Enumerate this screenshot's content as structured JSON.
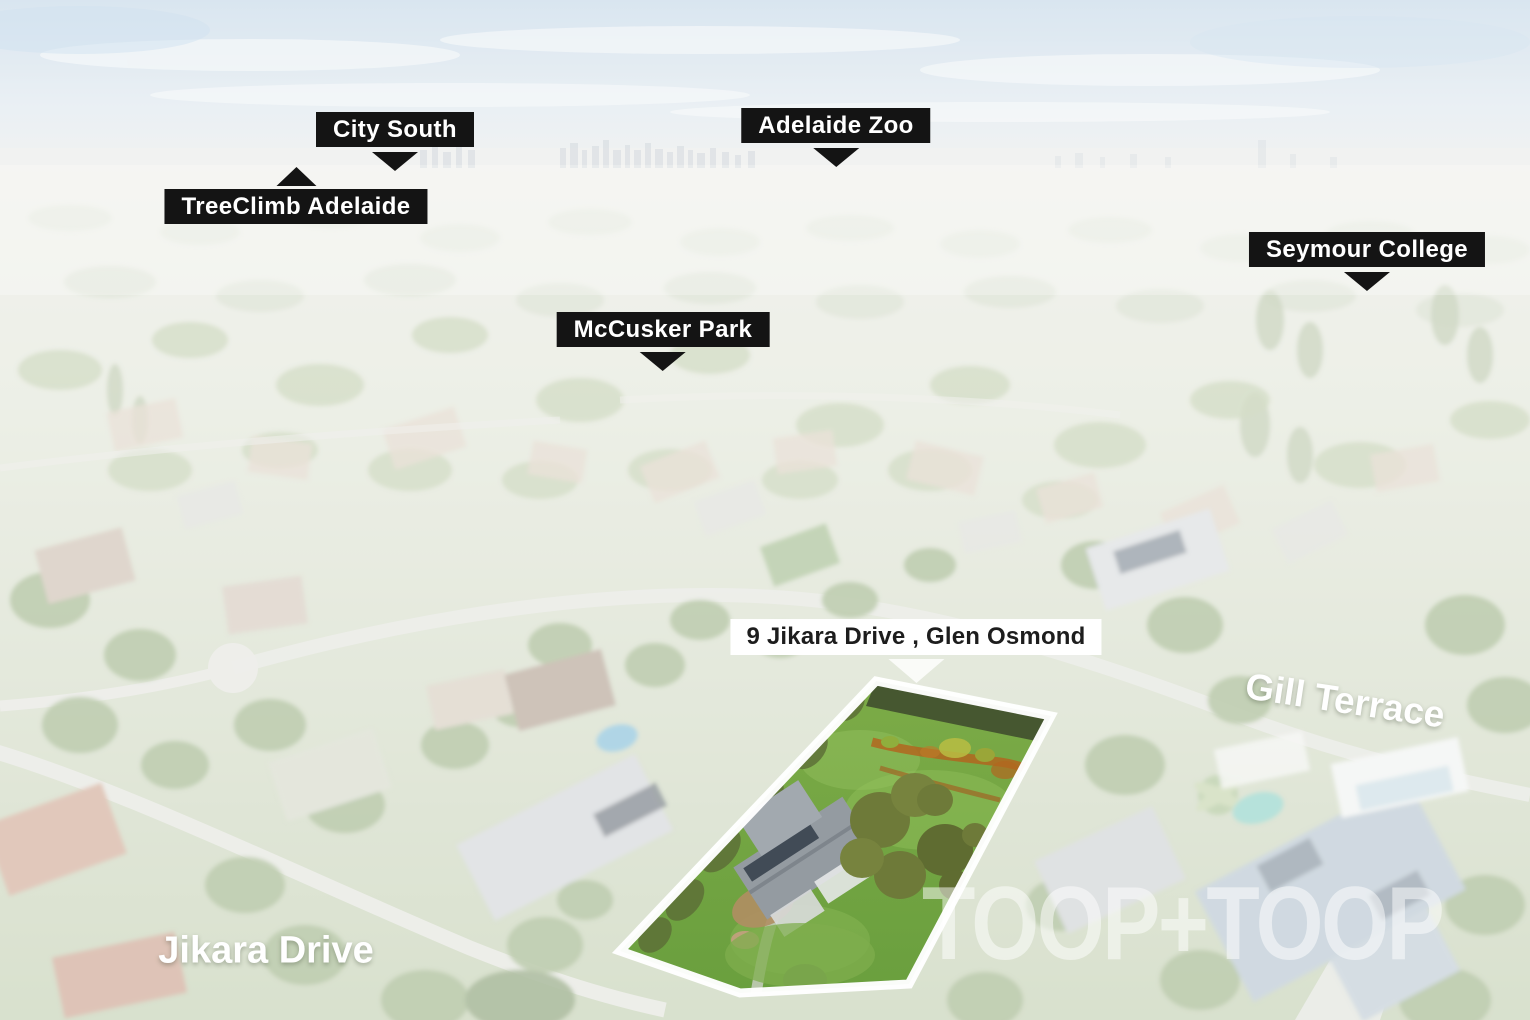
{
  "scene": {
    "watermark": "TOOP+TOOP"
  },
  "markers": [
    {
      "label": "City South",
      "pointer": "down"
    },
    {
      "label": "Adelaide Zoo",
      "pointer": "down"
    },
    {
      "label": "TreeClimb Adelaide",
      "pointer": "up"
    },
    {
      "label": "Seymour College",
      "pointer": "down"
    },
    {
      "label": "McCusker Park",
      "pointer": "down"
    }
  ],
  "property": {
    "address_label": "9 Jikara Drive , Glen Osmond",
    "boundary_color": "#ffffff"
  },
  "street_labels": [
    {
      "name": "Gill Terrace"
    },
    {
      "name": "Jikara Drive"
    }
  ],
  "colors": {
    "marker_bg": "#141414",
    "marker_text": "#ffffff",
    "address_bg": "#ffffff",
    "address_text": "#1d1d1d",
    "lot_grass": "#76a843",
    "lot_dirt": "#b2661f",
    "sky": "#b9d0e4"
  }
}
